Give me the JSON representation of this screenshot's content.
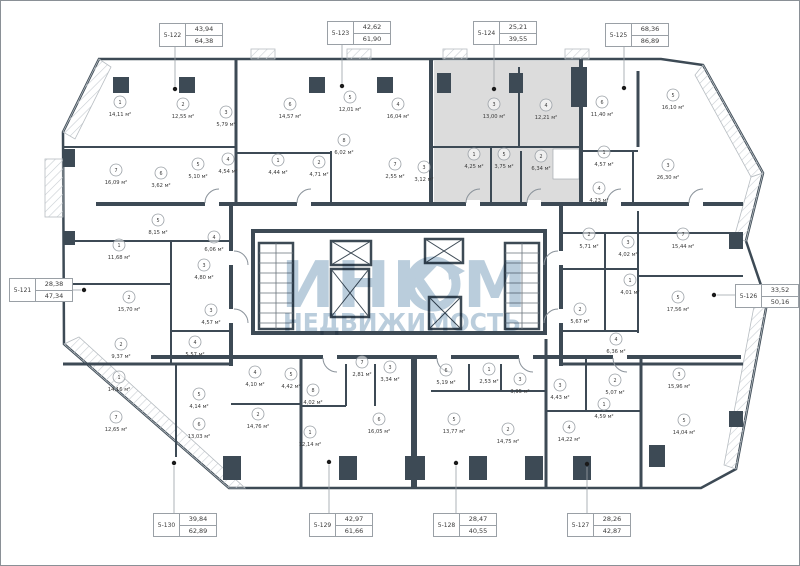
{
  "plan": {
    "kind": "residential-floor-plan",
    "highlighted_unit": "5-124"
  },
  "colors": {
    "wall": "#3d4a55",
    "highlight_fill": "#dcdcdc",
    "watermark": "#b3c8d8",
    "label_text": "#3a3a3a",
    "circle_stroke": "#9aa0a6"
  },
  "watermark": {
    "brand": "ИНКОМ",
    "brand_left": "ИНК",
    "brand_right": "М",
    "subtitle": "НЕДВИЖИМОСТЬ"
  },
  "units": [
    {
      "id": "5-122",
      "living": "43,94",
      "total": "64,38",
      "side": "top",
      "box": {
        "x": 158,
        "y": 22
      },
      "dot": {
        "x": 174,
        "y": 88
      }
    },
    {
      "id": "5-123",
      "living": "42,62",
      "total": "61,90",
      "side": "top",
      "box": {
        "x": 326,
        "y": 20
      },
      "dot": {
        "x": 341,
        "y": 85
      }
    },
    {
      "id": "5-124",
      "living": "25,21",
      "total": "39,55",
      "side": "top",
      "box": {
        "x": 472,
        "y": 20
      },
      "dot": {
        "x": 493,
        "y": 88
      }
    },
    {
      "id": "5-125",
      "living": "68,36",
      "total": "86,89",
      "side": "top",
      "box": {
        "x": 604,
        "y": 22
      },
      "dot": {
        "x": 623,
        "y": 87
      }
    },
    {
      "id": "5-121",
      "living": "28,38",
      "total": "47,34",
      "side": "left",
      "box": {
        "x": 8,
        "y": 277
      },
      "dot": {
        "x": 83,
        "y": 289
      }
    },
    {
      "id": "5-126",
      "living": "33,52",
      "total": "50,16",
      "side": "right",
      "box": {
        "x": 734,
        "y": 283
      },
      "dot": {
        "x": 713,
        "y": 294
      }
    },
    {
      "id": "5-130",
      "living": "39,84",
      "total": "62,89",
      "side": "bottom",
      "box": {
        "x": 152,
        "y": 512
      },
      "dot": {
        "x": 173,
        "y": 462
      }
    },
    {
      "id": "5-129",
      "living": "42,97",
      "total": "61,66",
      "side": "bottom",
      "box": {
        "x": 308,
        "y": 512
      },
      "dot": {
        "x": 328,
        "y": 461
      }
    },
    {
      "id": "5-128",
      "living": "28,47",
      "total": "40,55",
      "side": "bottom",
      "box": {
        "x": 432,
        "y": 512
      },
      "dot": {
        "x": 455,
        "y": 462
      }
    },
    {
      "id": "5-127",
      "living": "28,26",
      "total": "42,87",
      "side": "bottom",
      "box": {
        "x": 566,
        "y": 512
      },
      "dot": {
        "x": 586,
        "y": 463
      }
    }
  ],
  "rooms": [
    {
      "n": "1",
      "area": "14,11 м²",
      "x": 119,
      "y": 110
    },
    {
      "n": "2",
      "area": "12,55 м²",
      "x": 182,
      "y": 112
    },
    {
      "n": "3",
      "area": "5,79 м²",
      "x": 225,
      "y": 120
    },
    {
      "n": "7",
      "area": "16,09 м²",
      "x": 115,
      "y": 178
    },
    {
      "n": "6",
      "area": "3,62 м²",
      "x": 160,
      "y": 181
    },
    {
      "n": "5",
      "area": "5,10 м²",
      "x": 197,
      "y": 172
    },
    {
      "n": "4",
      "area": "4,54 м²",
      "x": 227,
      "y": 167
    },
    {
      "n": "6",
      "area": "14,57 м²",
      "x": 289,
      "y": 112
    },
    {
      "n": "5",
      "area": "12,01 м²",
      "x": 349,
      "y": 105
    },
    {
      "n": "4",
      "area": "16,04 м²",
      "x": 397,
      "y": 112
    },
    {
      "n": "8",
      "area": "6,02 м²",
      "x": 343,
      "y": 148
    },
    {
      "n": "1",
      "area": "4,44 м²",
      "x": 277,
      "y": 168
    },
    {
      "n": "2",
      "area": "4,71 м²",
      "x": 318,
      "y": 170
    },
    {
      "n": "7",
      "area": "2,55 м²",
      "x": 394,
      "y": 172
    },
    {
      "n": "3",
      "area": "3,12 м²",
      "x": 423,
      "y": 175
    },
    {
      "n": "3",
      "area": "13,00 м²",
      "x": 493,
      "y": 112
    },
    {
      "n": "4",
      "area": "12,21 м²",
      "x": 545,
      "y": 113
    },
    {
      "n": "1",
      "area": "4,25 м²",
      "x": 473,
      "y": 162
    },
    {
      "n": "5",
      "area": "3,75 м²",
      "x": 503,
      "y": 162
    },
    {
      "n": "2",
      "area": "6,34 м²",
      "x": 540,
      "y": 164
    },
    {
      "n": "6",
      "area": "11,40 м²",
      "x": 601,
      "y": 110
    },
    {
      "n": "5",
      "area": "16,10 м²",
      "x": 672,
      "y": 103
    },
    {
      "n": "1",
      "area": "4,57 м²",
      "x": 603,
      "y": 160
    },
    {
      "n": "3",
      "area": "26,30 м²",
      "x": 667,
      "y": 173
    },
    {
      "n": "4",
      "area": "4,23 м²",
      "x": 598,
      "y": 196
    },
    {
      "n": "5",
      "area": "8,15 м²",
      "x": 157,
      "y": 228
    },
    {
      "n": "1",
      "area": "11,68 м²",
      "x": 118,
      "y": 253
    },
    {
      "n": "4",
      "area": "6,06 м²",
      "x": 213,
      "y": 245
    },
    {
      "n": "3",
      "area": "4,80 м²",
      "x": 203,
      "y": 273
    },
    {
      "n": "2",
      "area": "15,70 м²",
      "x": 128,
      "y": 305
    },
    {
      "n": "3",
      "area": "4,57 м²",
      "x": 210,
      "y": 318
    },
    {
      "n": "2",
      "area": "9,37 м²",
      "x": 120,
      "y": 352
    },
    {
      "n": "4",
      "area": "5,57 м²",
      "x": 194,
      "y": 350
    },
    {
      "n": "1",
      "area": "14,16 м²",
      "x": 118,
      "y": 385
    },
    {
      "n": "7",
      "area": "12,65 м²",
      "x": 115,
      "y": 425
    },
    {
      "n": "5",
      "area": "4,14 м²",
      "x": 198,
      "y": 402
    },
    {
      "n": "6",
      "area": "13,03 м²",
      "x": 198,
      "y": 432
    },
    {
      "n": "4",
      "area": "4,10 м²",
      "x": 254,
      "y": 380
    },
    {
      "n": "5",
      "area": "4,42 м²",
      "x": 290,
      "y": 382
    },
    {
      "n": "2",
      "area": "14,76 м²",
      "x": 257,
      "y": 422
    },
    {
      "n": "7",
      "area": "2,81 м²",
      "x": 361,
      "y": 370
    },
    {
      "n": "3",
      "area": "3,34 м²",
      "x": 389,
      "y": 375
    },
    {
      "n": "8",
      "area": "4,02 м²",
      "x": 312,
      "y": 398
    },
    {
      "n": "1",
      "area": "12,14 м²",
      "x": 309,
      "y": 440
    },
    {
      "n": "6",
      "area": "16,05 м²",
      "x": 378,
      "y": 427
    },
    {
      "n": "6",
      "area": "5,19 м²",
      "x": 445,
      "y": 378
    },
    {
      "n": "1",
      "area": "2,53 м²",
      "x": 488,
      "y": 377
    },
    {
      "n": "5",
      "area": "13,77 м²",
      "x": 453,
      "y": 427
    },
    {
      "n": "2",
      "area": "14,75 м²",
      "x": 507,
      "y": 437
    },
    {
      "n": "4",
      "area": "6,36 м²",
      "x": 615,
      "y": 347
    },
    {
      "n": "3",
      "area": "3,95 м²",
      "x": 519,
      "y": 387
    },
    {
      "n": "3",
      "area": "4,43 м²",
      "x": 559,
      "y": 393
    },
    {
      "n": "2",
      "area": "5,07 м²",
      "x": 614,
      "y": 388
    },
    {
      "n": "1",
      "area": "4,59 м²",
      "x": 603,
      "y": 412
    },
    {
      "n": "3",
      "area": "15,96 м²",
      "x": 678,
      "y": 382
    },
    {
      "n": "5",
      "area": "14,04 м²",
      "x": 683,
      "y": 428
    },
    {
      "n": "4",
      "area": "14,22 м²",
      "x": 568,
      "y": 435
    },
    {
      "n": "2",
      "area": "5,71 м²",
      "x": 588,
      "y": 242
    },
    {
      "n": "3",
      "area": "4,02 м²",
      "x": 627,
      "y": 250
    },
    {
      "n": "7",
      "area": "15,44 м²",
      "x": 682,
      "y": 242
    },
    {
      "n": "1",
      "area": "4,01 м²",
      "x": 629,
      "y": 288
    },
    {
      "n": "5",
      "area": "17,56 м²",
      "x": 677,
      "y": 305
    },
    {
      "n": "2",
      "area": "5,67 м²",
      "x": 579,
      "y": 317
    }
  ]
}
